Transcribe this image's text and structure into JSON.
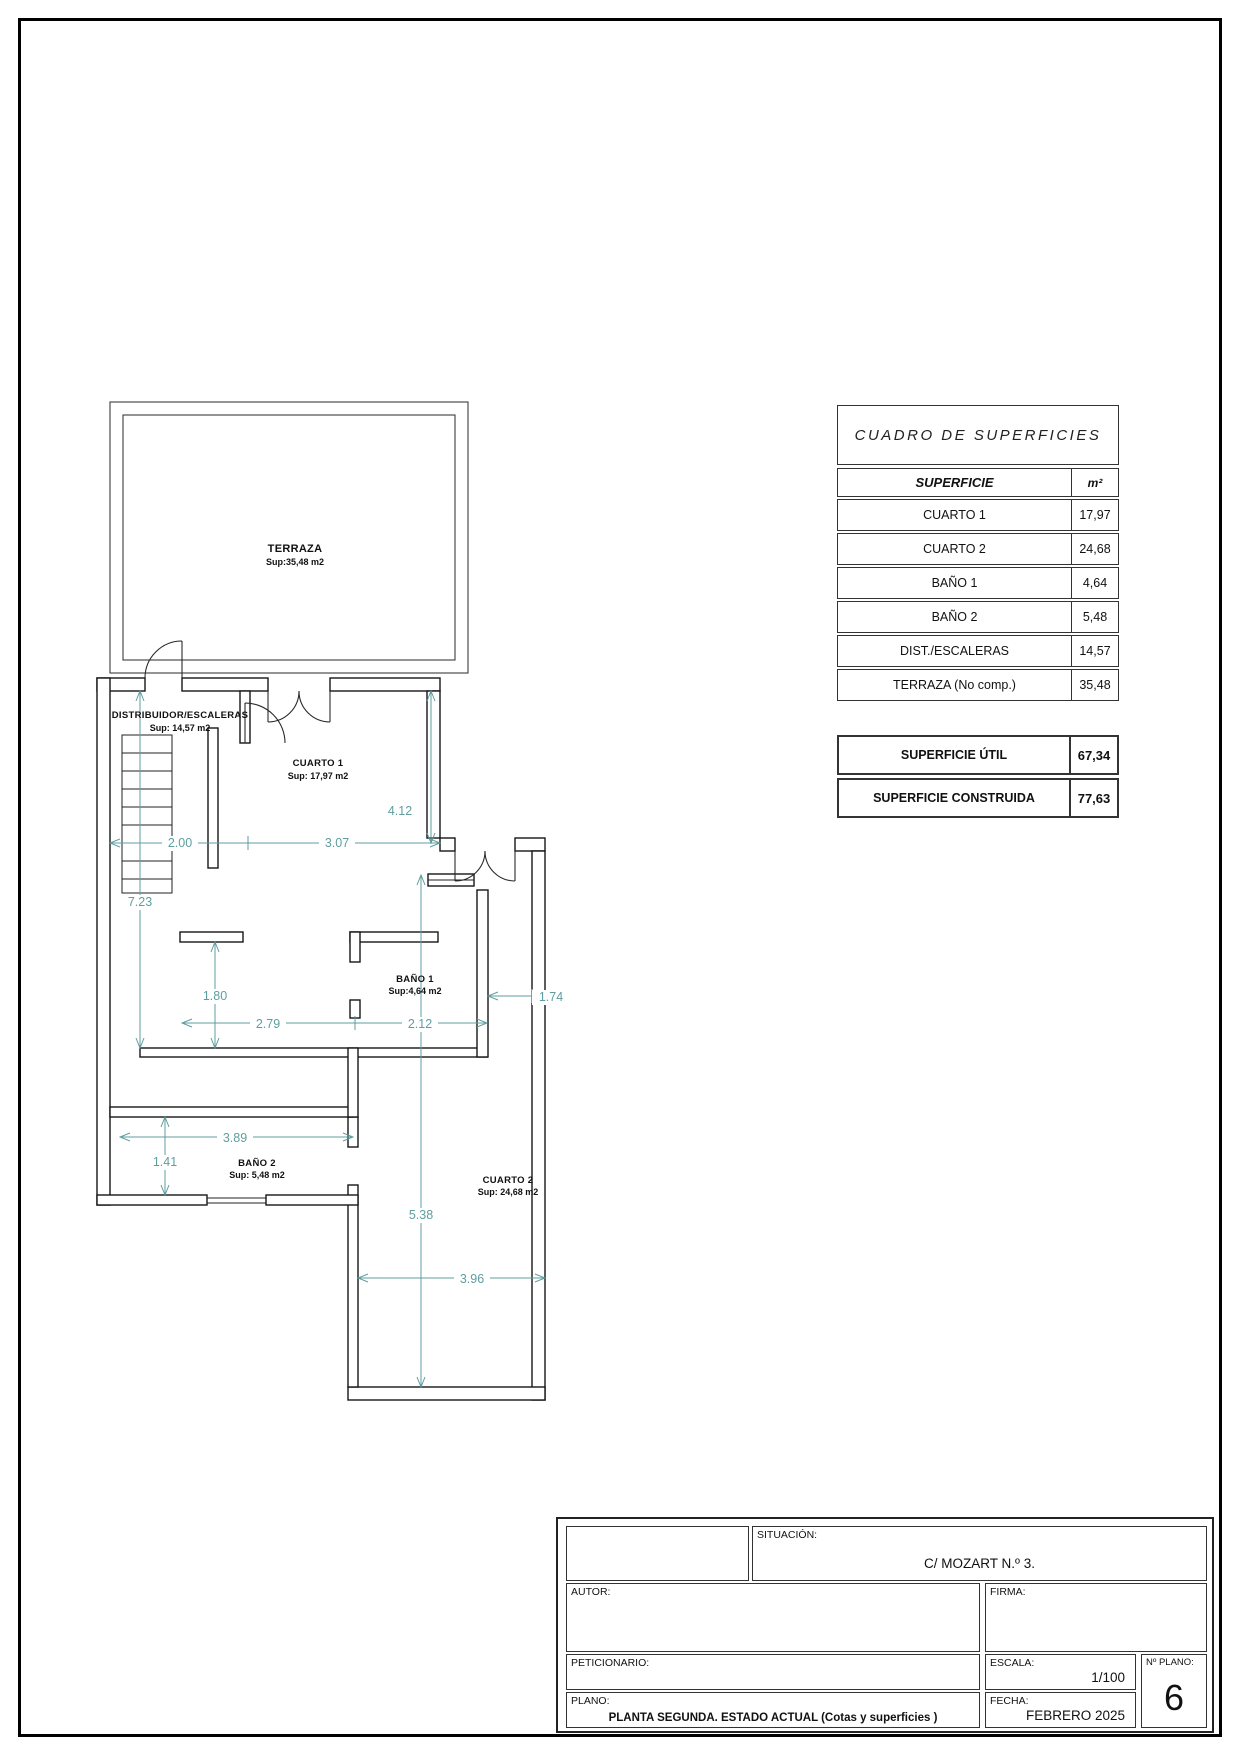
{
  "plan": {
    "dim_color": "#5f9ea0",
    "rooms": {
      "terraza": {
        "name": "TERRAZA",
        "sup": "Sup:35,48 m2"
      },
      "distribuidor": {
        "name": "DISTRIBUIDOR/ESCALERAS",
        "sup": "Sup: 14,57 m2"
      },
      "cuarto1": {
        "name": "CUARTO 1",
        "sup": "Sup: 17,97 m2"
      },
      "bano1": {
        "name": "BAÑO 1",
        "sup": "Sup:4,64 m2"
      },
      "bano2": {
        "name": "BAÑO 2",
        "sup": "Sup: 5,48 m2"
      },
      "cuarto2": {
        "name": "CUARTO 2",
        "sup": "Sup: 24,68 m2"
      }
    },
    "dims": {
      "d200": "2.00",
      "d307": "3.07",
      "d412": "4.12",
      "d723": "7.23",
      "d180": "1.80",
      "d279": "2.79",
      "d212": "2.12",
      "d174": "1.74",
      "d389": "3.89",
      "d141": "1.41",
      "d538": "5.38",
      "d396": "3.96"
    }
  },
  "surfaces_table": {
    "title": "CUADRO DE SUPERFICIES",
    "header": {
      "label": "SUPERFICIE",
      "unit": "m²"
    },
    "rows": [
      {
        "label": "CUARTO 1",
        "value": "17,97"
      },
      {
        "label": "CUARTO 2",
        "value": "24,68"
      },
      {
        "label": "BAÑO 1",
        "value": "4,64"
      },
      {
        "label": "BAÑO 2",
        "value": "5,48"
      },
      {
        "label": "DIST./ESCALERAS",
        "value": "14,57"
      },
      {
        "label": "TERRAZA (No comp.)",
        "value": "35,48"
      }
    ]
  },
  "summary": {
    "rows": [
      {
        "label": "SUPERFICIE ÚTIL",
        "value": "67,34"
      },
      {
        "label": "SUPERFICIE CONSTRUIDA",
        "value": "77,63"
      }
    ]
  },
  "title_block": {
    "situacion_label": "SITUACIÓN:",
    "situacion_value": "C/ MOZART  N.º 3.",
    "autor_label": "AUTOR:",
    "firma_label": "FIRMA:",
    "peticionario_label": "PETICIONARIO:",
    "escala_label": "ESCALA:",
    "escala_value": "1/100",
    "nplano_label": "Nº PLANO:",
    "nplano_value": "6",
    "plano_label": "PLANO:",
    "plano_value": "PLANTA SEGUNDA. ESTADO ACTUAL (Cotas y superficies )",
    "fecha_label": "FECHA:",
    "fecha_value": "FEBRERO 2025"
  }
}
